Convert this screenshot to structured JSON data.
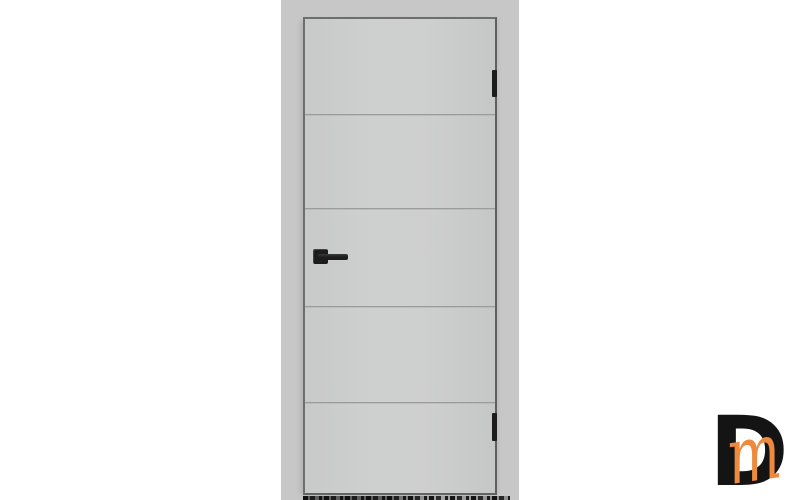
{
  "colors": {
    "page_bg": "#ffffff",
    "wall": "#c7c7c7",
    "door_face": "#cccdcd",
    "door_edge": "#6e6e6e",
    "groove": "#9b9b9b",
    "hardware": "#1c1c1c",
    "logo_d": "#141414",
    "logo_m": "#ed8a3d"
  },
  "door": {
    "panel_count": 5,
    "groove_count": 4,
    "hinge_count": 2,
    "handle_side": "left",
    "finish": "light grey"
  },
  "watermark": {
    "letter_d": "D",
    "letter_m": "m"
  }
}
